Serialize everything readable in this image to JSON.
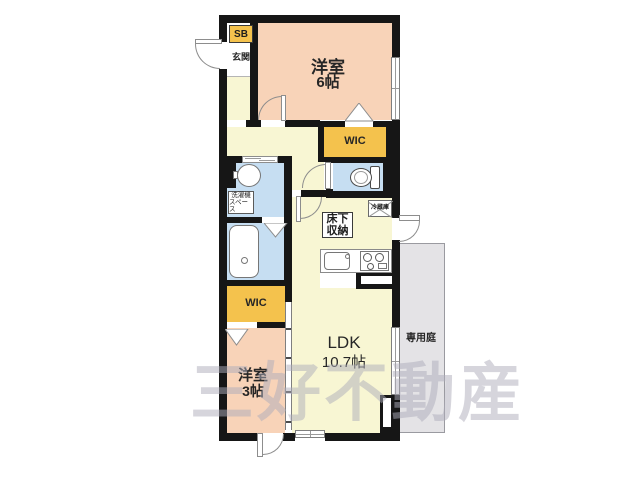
{
  "watermark": "三好不動産",
  "rooms": {
    "bedroom6": {
      "name": "洋室",
      "size": "6帖"
    },
    "bedroom3": {
      "name": "洋室",
      "size": "3帖"
    },
    "ldk": {
      "name": "LDK",
      "size": "10.7帖"
    },
    "wic_north": {
      "name": "WIC"
    },
    "wic_south": {
      "name": "WIC"
    },
    "entrance": {
      "name": "玄関"
    },
    "shoebox": {
      "name": "SB"
    },
    "garden": {
      "name": "専用庭"
    }
  },
  "fixtures": {
    "laundry_space": {
      "line1": "洗濯機",
      "line2": "スペース"
    },
    "underfloor_storage": {
      "line1": "床下",
      "line2": "収納"
    },
    "refrigerator": {
      "name": "冷蔵庫"
    }
  },
  "icons": {
    "toilet": "toilet-icon",
    "bathtub": "bathtub-icon",
    "washbasin": "washbasin-icon",
    "kitchen_sink": "kitchen-sink-icon",
    "stove": "stove-icon",
    "door_swing": "door-swing-arc-icon",
    "window": "window-symbol-icon",
    "folding_door": "folding-door-triangle-icon"
  },
  "colors": {
    "wall": "#161616",
    "bedroom_pink": "#f8d3b8",
    "hall_ldk_yellow": "#f8f6d3",
    "wic_gold": "#f4c24d",
    "wet_blue": "#c6def2",
    "garden_gray": "#e4e3e6",
    "watermark_gray": "#aeadbb"
  }
}
